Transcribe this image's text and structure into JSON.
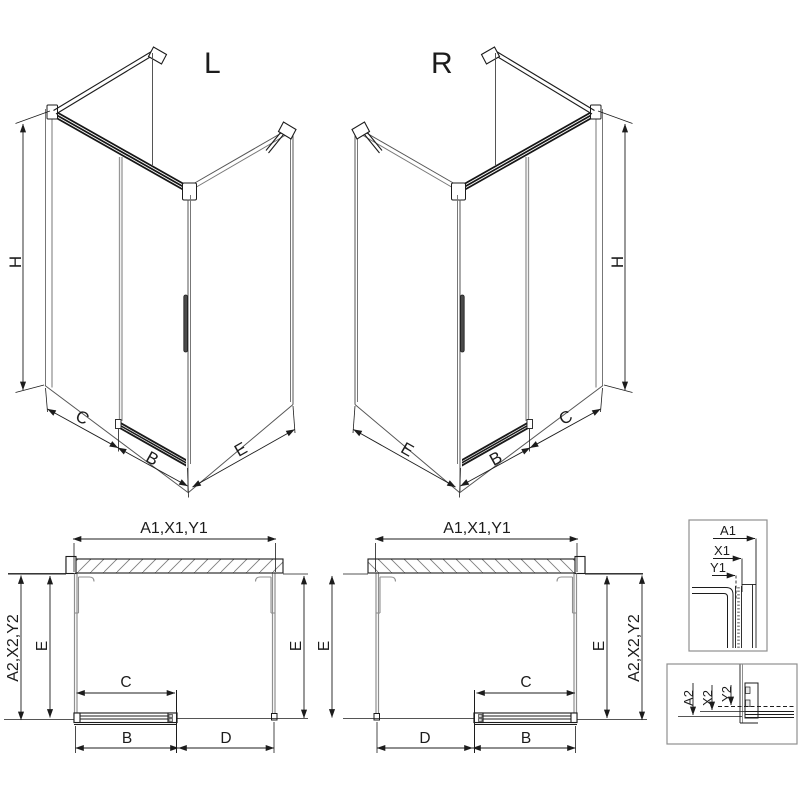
{
  "views": {
    "iso_left": {
      "title": "L",
      "dims": {
        "height": "H",
        "panel_c": "C",
        "door_b": "B",
        "side_e": "E"
      }
    },
    "iso_right": {
      "title": "R",
      "dims": {
        "height": "H",
        "panel_c": "C",
        "door_b": "B",
        "side_e": "E"
      }
    },
    "plan_left": {
      "dim_top": "A1,X1,Y1",
      "dim_side": "A2,X2,Y2",
      "dim_e_left": "E",
      "dim_e_right": "E",
      "dim_c": "C",
      "dim_b": "B",
      "dim_d": "D"
    },
    "plan_right": {
      "dim_top": "A1,X1,Y1",
      "dim_side": "A2,X2,Y2",
      "dim_e_left": "E",
      "dim_e_right": "E",
      "dim_c": "C",
      "dim_b": "B",
      "dim_d": "D"
    },
    "detail_top": {
      "dim_a1": "A1",
      "dim_x1": "X1",
      "dim_y1": "Y1"
    },
    "detail_bottom": {
      "dim_a2": "A2",
      "dim_x2": "X2",
      "dim_y2": "Y2"
    }
  },
  "colors": {
    "line": "#1c1c1c",
    "glass": "#8f8f8f",
    "rail": "#161616",
    "background": "#ffffff"
  }
}
